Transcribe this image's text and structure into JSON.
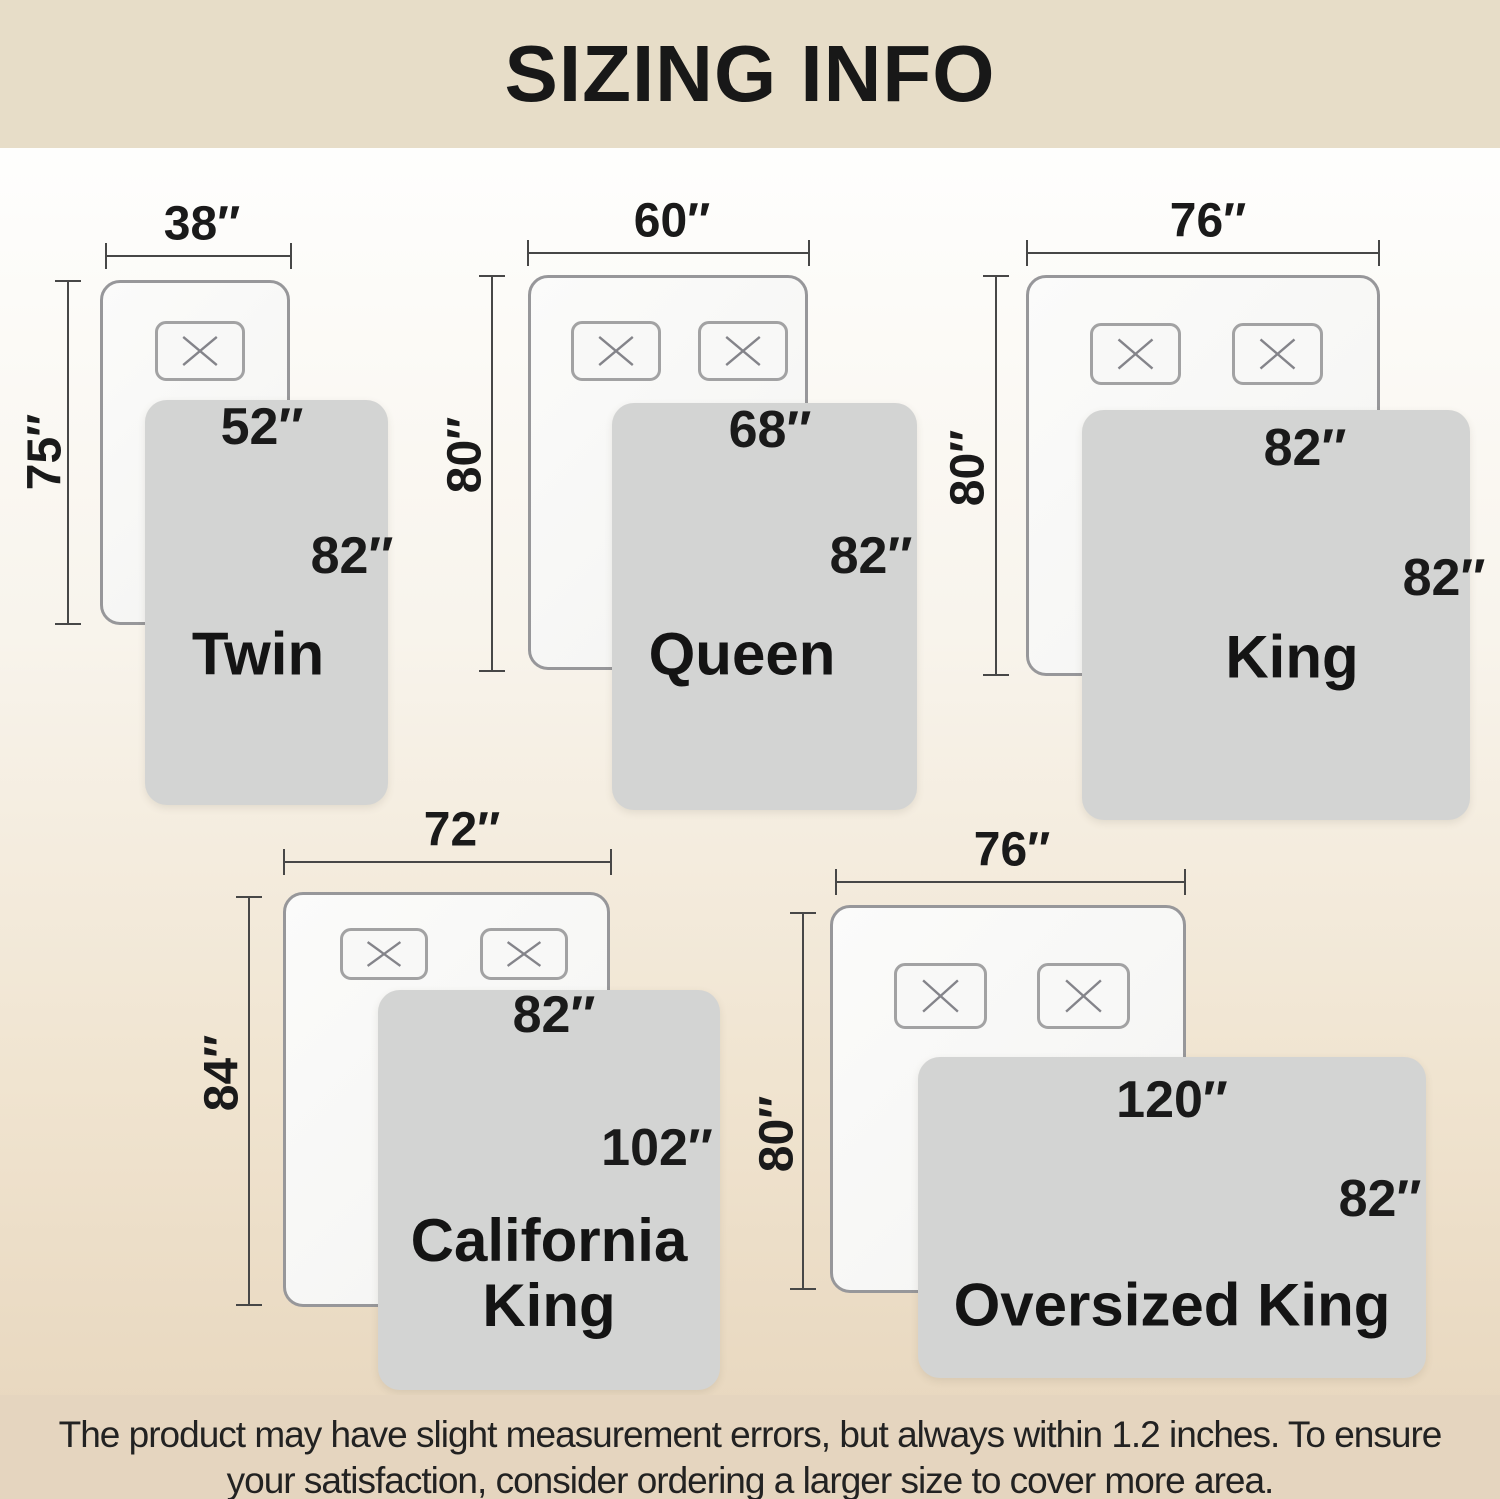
{
  "title": "SIZING INFO",
  "footer_note": "The product may have slight measurement errors, but always within 1.2 inches. To ensure your satisfaction, consider ordering a larger size to cover more area.",
  "colors": {
    "header_bg": "#e7ddc8",
    "footer_bg": "#e5d5bf",
    "blanket_gray": "#d3d4d3",
    "mattress_white": "#f8f8f6",
    "dimension_line": "#474747",
    "text": "#1a1a1a"
  },
  "beds": [
    {
      "name": "Twin",
      "mattress_width": "38″",
      "mattress_length": "75″",
      "blanket_width": "52″",
      "blanket_length": "82″",
      "pillow_count": 1
    },
    {
      "name": "Queen",
      "mattress_width": "60″",
      "mattress_length": "80″",
      "blanket_width": "68″",
      "blanket_length": "82″",
      "pillow_count": 2
    },
    {
      "name": "King",
      "mattress_width": "76″",
      "mattress_length": "80″",
      "blanket_width": "82″",
      "blanket_length": "82″",
      "pillow_count": 2
    },
    {
      "name": "California King",
      "mattress_width": "72″",
      "mattress_length": "84″",
      "blanket_width": "82″",
      "blanket_length": "102″",
      "pillow_count": 2
    },
    {
      "name": "Oversized King",
      "mattress_width": "76″",
      "mattress_length": "80″",
      "blanket_width": "120″",
      "blanket_length": "82″",
      "pillow_count": 2
    }
  ]
}
